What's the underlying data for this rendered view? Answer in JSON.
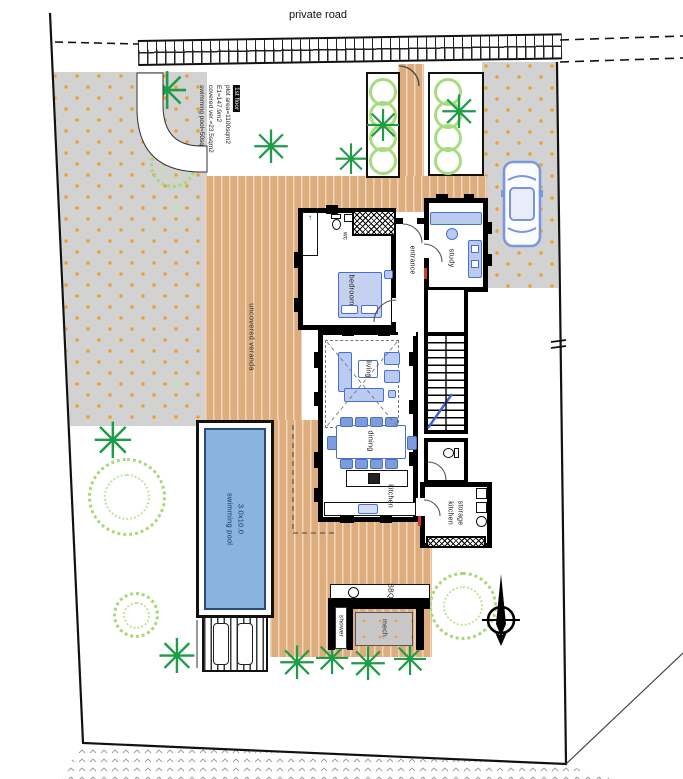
{
  "site": {
    "road_label": "private road",
    "notes": {
      "line1": "1st floor",
      "line2": "plot area=1100sqm2",
      "line3": "E1=147.9m2",
      "line4": "covered ver.=23.5sqm2",
      "line5": "swimming pool=50sqm2"
    }
  },
  "rooms": {
    "wc": "wc",
    "bedroom": "bedroom",
    "entrance": "entrance",
    "study": "study",
    "living": "living",
    "dining": "dining",
    "kitchen": "kitchen",
    "kitchen_storage_1": "kitchen",
    "kitchen_storage_2": "storage"
  },
  "outdoor": {
    "veranda": "uncovered veranda",
    "bbq": "BBQ",
    "mech": "mech.",
    "shower": "shower"
  },
  "pool": {
    "label": "swimming pool",
    "size": "3.0x10.0"
  },
  "icons": {
    "palm": "✳",
    "closet_arrow": "↑"
  },
  "colors": {
    "deck": "#ddad7d",
    "pool_water": "#8ab4e0",
    "furniture_blue": "#4a6fd0",
    "tree_green": "#1e9c46",
    "bush_green": "#a6d977",
    "paving_gray": "#d2d2d2",
    "paving_dot_orange": "#ef9f2e",
    "wall_black": "#000000",
    "door_red": "#d23b2f"
  }
}
